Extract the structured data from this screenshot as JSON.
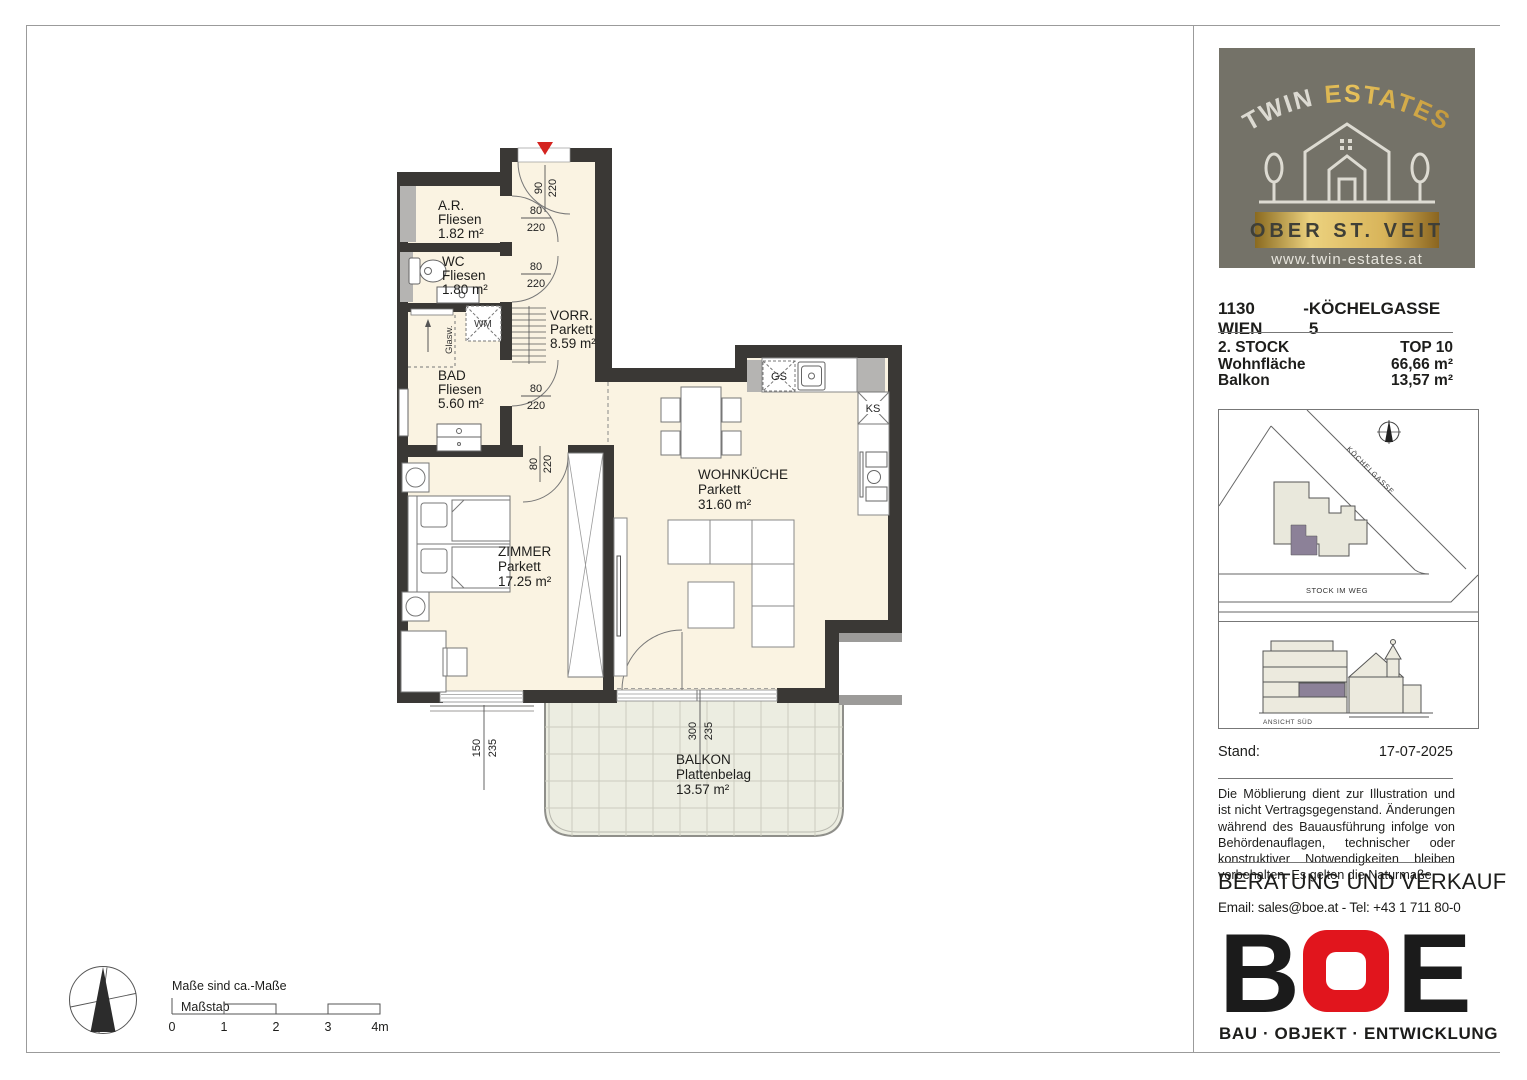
{
  "plan": {
    "rooms": {
      "ar": {
        "name": "A.R.",
        "floor": "Fliesen",
        "area": "1.82 m²"
      },
      "wc": {
        "name": "WC",
        "floor": "Fliesen",
        "area": "1.80 m²"
      },
      "vorr": {
        "name": "VORR.",
        "floor": "Parkett",
        "area": "8.59 m²"
      },
      "bad": {
        "name": "BAD",
        "floor": "Fliesen",
        "area": "5.60 m²"
      },
      "zimmer": {
        "name": "ZIMMER",
        "floor": "Parkett",
        "area": "17.25 m²"
      },
      "wohnkueche": {
        "name": "WOHNKÜCHE",
        "floor": "Parkett",
        "area": "31.60 m²"
      },
      "balkon": {
        "name": "BALKON",
        "floor": "Plattenbelag",
        "area": "13.57 m²"
      }
    },
    "fixtures": {
      "wm": "WM",
      "gs": "GS",
      "ks": "KS",
      "glass_wall": "Glasw."
    },
    "dims": {
      "entry": {
        "w": "90",
        "h": "220"
      },
      "door_ar": {
        "w": "80",
        "h": "220"
      },
      "door_wc": {
        "w": "80",
        "h": "220"
      },
      "door_bad": {
        "w": "80",
        "h": "220"
      },
      "door_zimmer": {
        "w": "80",
        "h": "220"
      },
      "window_zimmer": {
        "w": "150",
        "h": "235"
      },
      "balcony_door": {
        "w": "300",
        "h": "235"
      }
    }
  },
  "footer": {
    "note": "Maße sind ca.-Maße",
    "scale_label": "Maßstab",
    "ticks": [
      "0",
      "1",
      "2",
      "3",
      "4m"
    ]
  },
  "sidebar": {
    "logo": {
      "brand_1": "TWIN",
      "brand_2": "ESTATES",
      "location": "OBER ST. VEIT",
      "website": "www.twin-estates.at"
    },
    "address": {
      "city": "1130 WIEN",
      "sep": "-",
      "street": "KÖCHELGASSE 5"
    },
    "details": [
      {
        "label": "2. STOCK",
        "value": "TOP 10"
      },
      {
        "label": "Wohnfläche",
        "value": "66,66 m²"
      },
      {
        "label": "Balkon",
        "value": "13,57 m²"
      }
    ],
    "map": {
      "street_diagonal": "KÖCHELGASSE",
      "street_horizontal": "STOCK IM WEG"
    },
    "elevation": {
      "label": "ANSICHT SÜD"
    },
    "stand": {
      "label": "Stand:",
      "date": "17-07-2025"
    },
    "disclaimer": "Die Möblierung dient zur Illustration und ist nicht Vertragsgegenstand. Änderungen während des Bauausführung infolge von Behördenauflagen, technischer oder konstruktiver Notwendigkeiten bleiben vorbehalten. Es gelten die Naturmaße.",
    "contact": {
      "heading": "BERATUNG UND VERKAUF",
      "line": "Email: sales@boe.at  -  Tel: +43 1 711 80-0"
    },
    "boe": {
      "b": "B",
      "o": "O",
      "e": "E",
      "tagline": "BAU · OBJEKT · ENTWICKLUNG"
    }
  },
  "colors": {
    "wall": "#3a3835",
    "room": "#faf3e2",
    "balcony": "#ecede1",
    "accent_red": "#d42420",
    "logo_olive": "#747268",
    "gold": "#cda23f",
    "unit_purple": "#8c8198",
    "boe_red": "#e1151d"
  }
}
